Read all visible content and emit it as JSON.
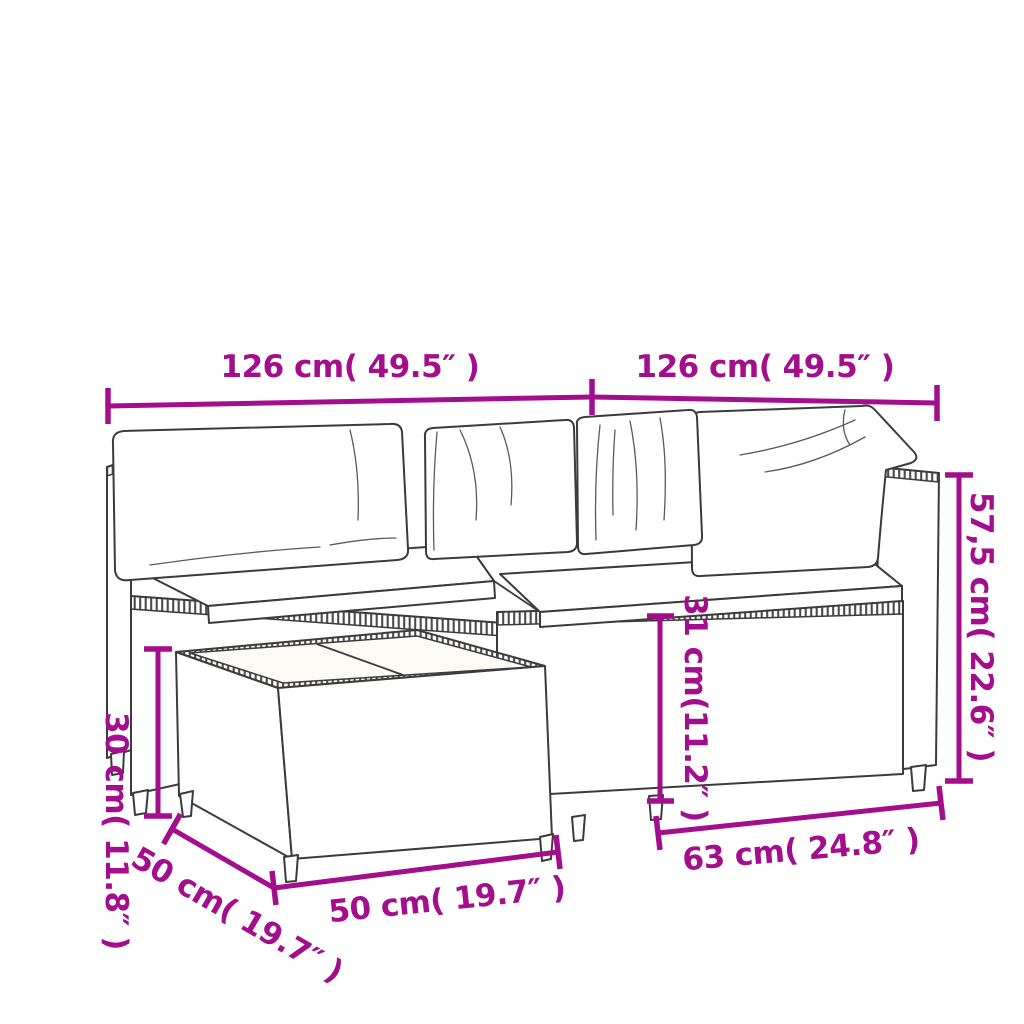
{
  "illustration": {
    "subject": "poly rattan garden corner sofa set with white cushions and square coffee table",
    "style": "black line-art product dimension diagram"
  },
  "colors": {
    "dimension_accent": "#A20E8C",
    "line_art": "#3B3B3B",
    "background": "#FFFFFF",
    "cushion_fill": "#FEFEFE",
    "seat_fill": "#F8F6EE"
  },
  "dimensions": {
    "top_left_width": {
      "label": "126 cm( 49.5″ )"
    },
    "top_right_width": {
      "label": "126 cm( 49.5″ )"
    },
    "back_height": {
      "label": "57,5 cm( 22.6″ )"
    },
    "seat_height": {
      "label": "31 cm(11.2″ )"
    },
    "table_height": {
      "label": "30 cm( 11.8″ )"
    },
    "table_depth": {
      "label": "50 cm( 19.7″ )"
    },
    "table_width": {
      "label": "50 cm( 19.7″ )"
    },
    "right_module_depth": {
      "label": "63 cm( 24.8″ )"
    }
  }
}
